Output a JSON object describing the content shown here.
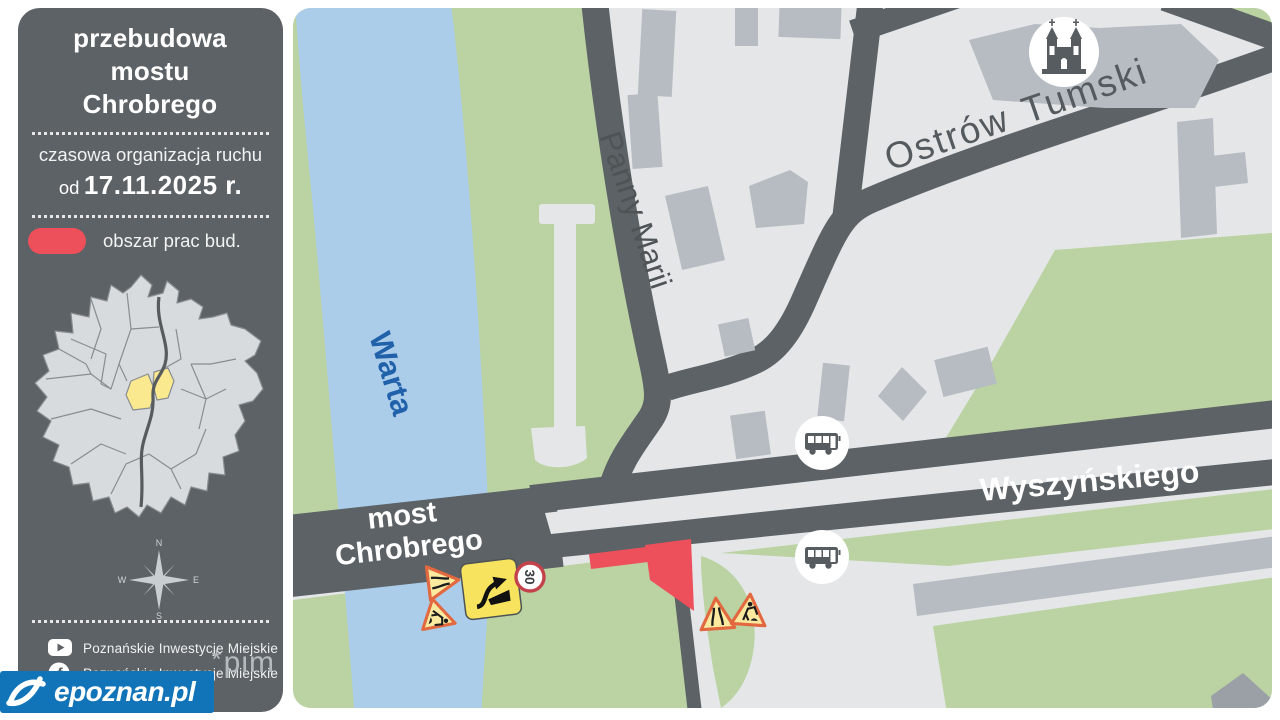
{
  "sidebar": {
    "title": "przebudowa mostu Chrobrego",
    "subtitle": "czasowa organizacja ruchu",
    "date_prefix": "od",
    "date": "17.11.2025 r.",
    "legend_label": "obszar prac bud.",
    "compass": {
      "n": "N",
      "e": "E",
      "s": "S",
      "w": "W"
    },
    "social": [
      {
        "icon": "youtube-icon",
        "label": "Poznańskie Inwestycje Miejskie"
      },
      {
        "icon": "facebook-icon",
        "glyph": "f",
        "label": "Poznańskie Inwestycje Miejskie"
      }
    ],
    "brand_star": "*",
    "brand": "pim"
  },
  "footer": {
    "logo_text": "epoznan.pl"
  },
  "map": {
    "labels": {
      "river": "Warta",
      "bridge_line1": "most",
      "bridge_line2": "Chrobrego",
      "street_side": "Panny Marii",
      "street_main": "Wyszyńskiego",
      "district_word1": "Ostrów",
      "district_word2": "Tumski",
      "speed_limit": "30"
    },
    "colors": {
      "work_area": "#ed4f5b",
      "road": "#5c6265",
      "green": "#bbd3a2",
      "river": "#abcdea",
      "building": "#b6bcc2",
      "panel": "#5c6265",
      "epoznan_blue": "#1173b8",
      "sign_yellow": "#f7e35e"
    }
  }
}
